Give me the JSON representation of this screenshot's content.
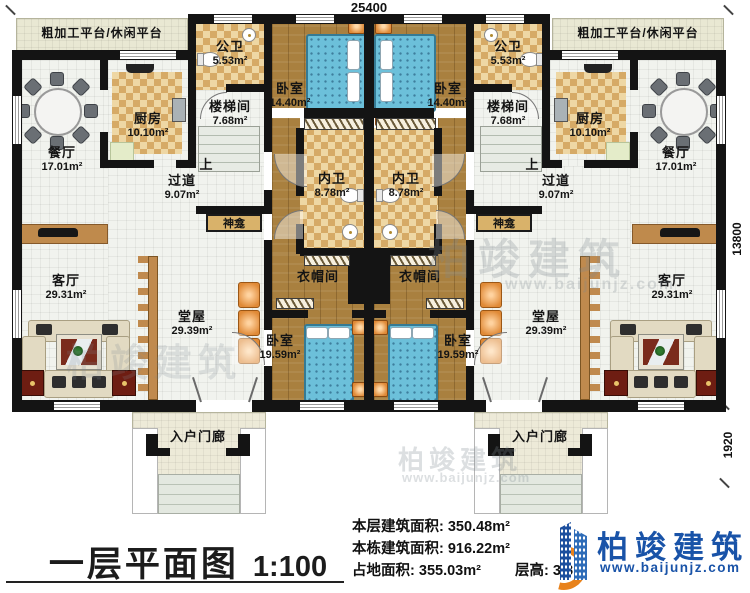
{
  "dimensions": {
    "top_width": "25400",
    "right_height": "13800",
    "porch_depth": "1920"
  },
  "units": {
    "left": {
      "platform": "粗加工平台/休闲平台",
      "public_bath": {
        "name": "公卫",
        "area": "5.53m²"
      },
      "bedroom_top": {
        "name": "卧室",
        "area": "14.40m²"
      },
      "kitchen": {
        "name": "厨房",
        "area": "10.10m²"
      },
      "stairwell": {
        "name": "楼梯间",
        "area": "7.68m²"
      },
      "up": "上",
      "dining": {
        "name": "餐厅",
        "area": "17.01m²"
      },
      "corridor": {
        "name": "过道",
        "area": "9.07m²"
      },
      "inner_bath": {
        "name": "内卫",
        "area": "8.78m²"
      },
      "shrine": "神龛",
      "closet": "衣帽间",
      "hall": {
        "name": "堂屋",
        "area": "29.39m²"
      },
      "living": {
        "name": "客厅",
        "area": "29.31m²"
      },
      "bedroom_bottom": {
        "name": "卧室",
        "area": "19.59m²"
      },
      "porch": "入户门廊"
    },
    "right": {
      "platform": "粗加工平台/休闲平台",
      "public_bath": {
        "name": "公卫",
        "area": "5.53m²"
      },
      "bedroom_top": {
        "name": "卧室",
        "area": "14.40m²"
      },
      "kitchen": {
        "name": "厨房",
        "area": "10.10m²"
      },
      "stairwell": {
        "name": "楼梯间",
        "area": "7.68m²"
      },
      "up": "上",
      "dining": {
        "name": "餐厅",
        "area": "17.01m²"
      },
      "corridor": {
        "name": "过道",
        "area": "9.07m²"
      },
      "inner_bath": {
        "name": "内卫",
        "area": "8.78m²"
      },
      "shrine": "神龛",
      "closet": "衣帽间",
      "hall": {
        "name": "堂屋",
        "area": "29.39m²"
      },
      "living": {
        "name": "客厅",
        "area": "29.31m²"
      },
      "bedroom_bottom": {
        "name": "卧室",
        "area": "19.59m²"
      },
      "porch": "入户门廊"
    }
  },
  "footer": {
    "title": "一层平面图",
    "scale": "1:100",
    "stats": [
      {
        "label": "本层建筑面积:",
        "value": "350.48m²"
      },
      {
        "label": "本栋建筑面积:",
        "value": "916.22m²"
      },
      {
        "label": "占地面积:",
        "value": "355.03m²"
      },
      {
        "label": "层高:",
        "value": "3.8m"
      }
    ],
    "brand": "柏竣建筑",
    "website": "www.baijunjz.com"
  },
  "watermark": {
    "brand": "柏竣建筑",
    "website": "www.baijunjz.com"
  },
  "colors": {
    "wall": "#141414",
    "wood": "#a9803f",
    "checker_light": "#eed7a4",
    "checker_dark": "#d6aa66",
    "floor_light": "#f1f3ee",
    "platform": "#e9e8d3",
    "bed_blue": "#6cc0da",
    "accent_orange": "#e08a37",
    "brand_blue": "#1953a8",
    "brand_orange": "#e8821c"
  }
}
